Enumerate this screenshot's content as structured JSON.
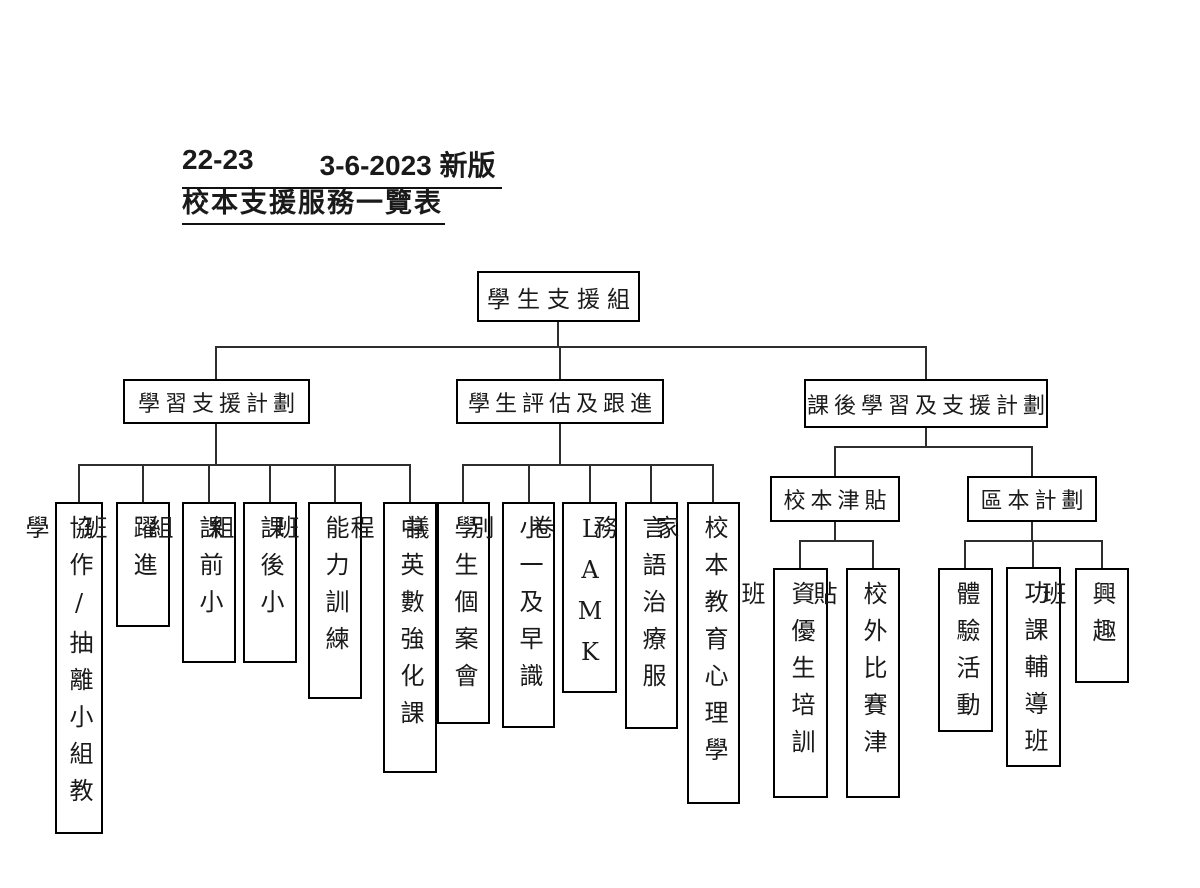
{
  "header": {
    "version_line": {
      "left": "22-23",
      "right": "3-6-2023 新版"
    },
    "title": "校本支援服務一覽表"
  },
  "org": {
    "root": {
      "label": "學生支援組"
    },
    "branches": [
      {
        "label": "學習支援計劃",
        "children": [
          {
            "label": "協作/抽離小組教學"
          },
          {
            "label": "躍進班"
          },
          {
            "label": "課前小組"
          },
          {
            "label": "課後小組"
          },
          {
            "label": "能力訓練班"
          },
          {
            "label": "中英數強化課程"
          }
        ]
      },
      {
        "label": "學生評估及跟進",
        "children": [
          {
            "label": "學生個案會議"
          },
          {
            "label": "小一及早識別"
          },
          {
            "label": "LAMK卷"
          },
          {
            "label": "言語治療服務"
          },
          {
            "label": "校本教育心理學家"
          }
        ]
      },
      {
        "label": "課後學習及支援計劃",
        "children": [
          {
            "label": "校本津貼",
            "children": [
              {
                "label": "資優生培訓班"
              },
              {
                "label": "校外比賽津貼"
              }
            ]
          },
          {
            "label": "區本計劃",
            "children": [
              {
                "label": "體驗活動"
              },
              {
                "label": "功課輔導班"
              },
              {
                "label": "興趣班"
              }
            ]
          }
        ]
      }
    ]
  }
}
